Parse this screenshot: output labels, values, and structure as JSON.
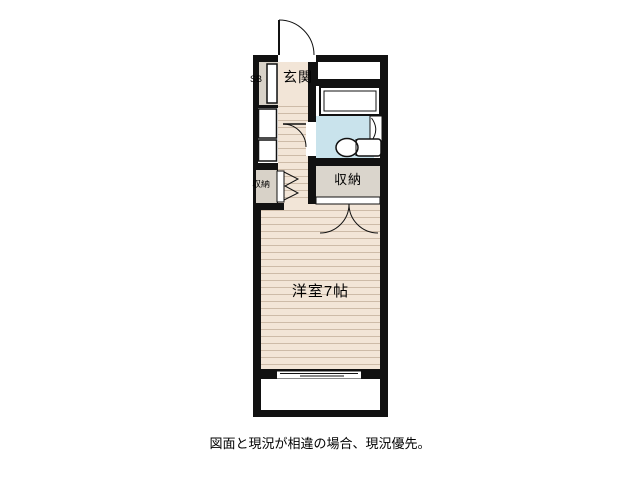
{
  "floor_plan": {
    "labels": {
      "entrance": "玄関",
      "shoe_box": "SB",
      "left_closet": "収納",
      "right_closet": "収納",
      "main_room": "洋室7帖"
    },
    "caption": "図面と現況が相違の場合、現況優先。",
    "colors": {
      "wall": "#111111",
      "flooring": "#F2E5D7",
      "flooring_stripe": "#CDBBA8",
      "bathroom_floor": "#C9E3EC",
      "closet": "#DAD5CC",
      "fixture": "#FFFFFF"
    },
    "fixtures": [
      "entrance-swing-door",
      "shoe-cabinet",
      "bifold-closet-door",
      "bathroom-swing-door",
      "bathtub",
      "toilet",
      "double-door-closet",
      "sliding-window",
      "balcony"
    ]
  }
}
